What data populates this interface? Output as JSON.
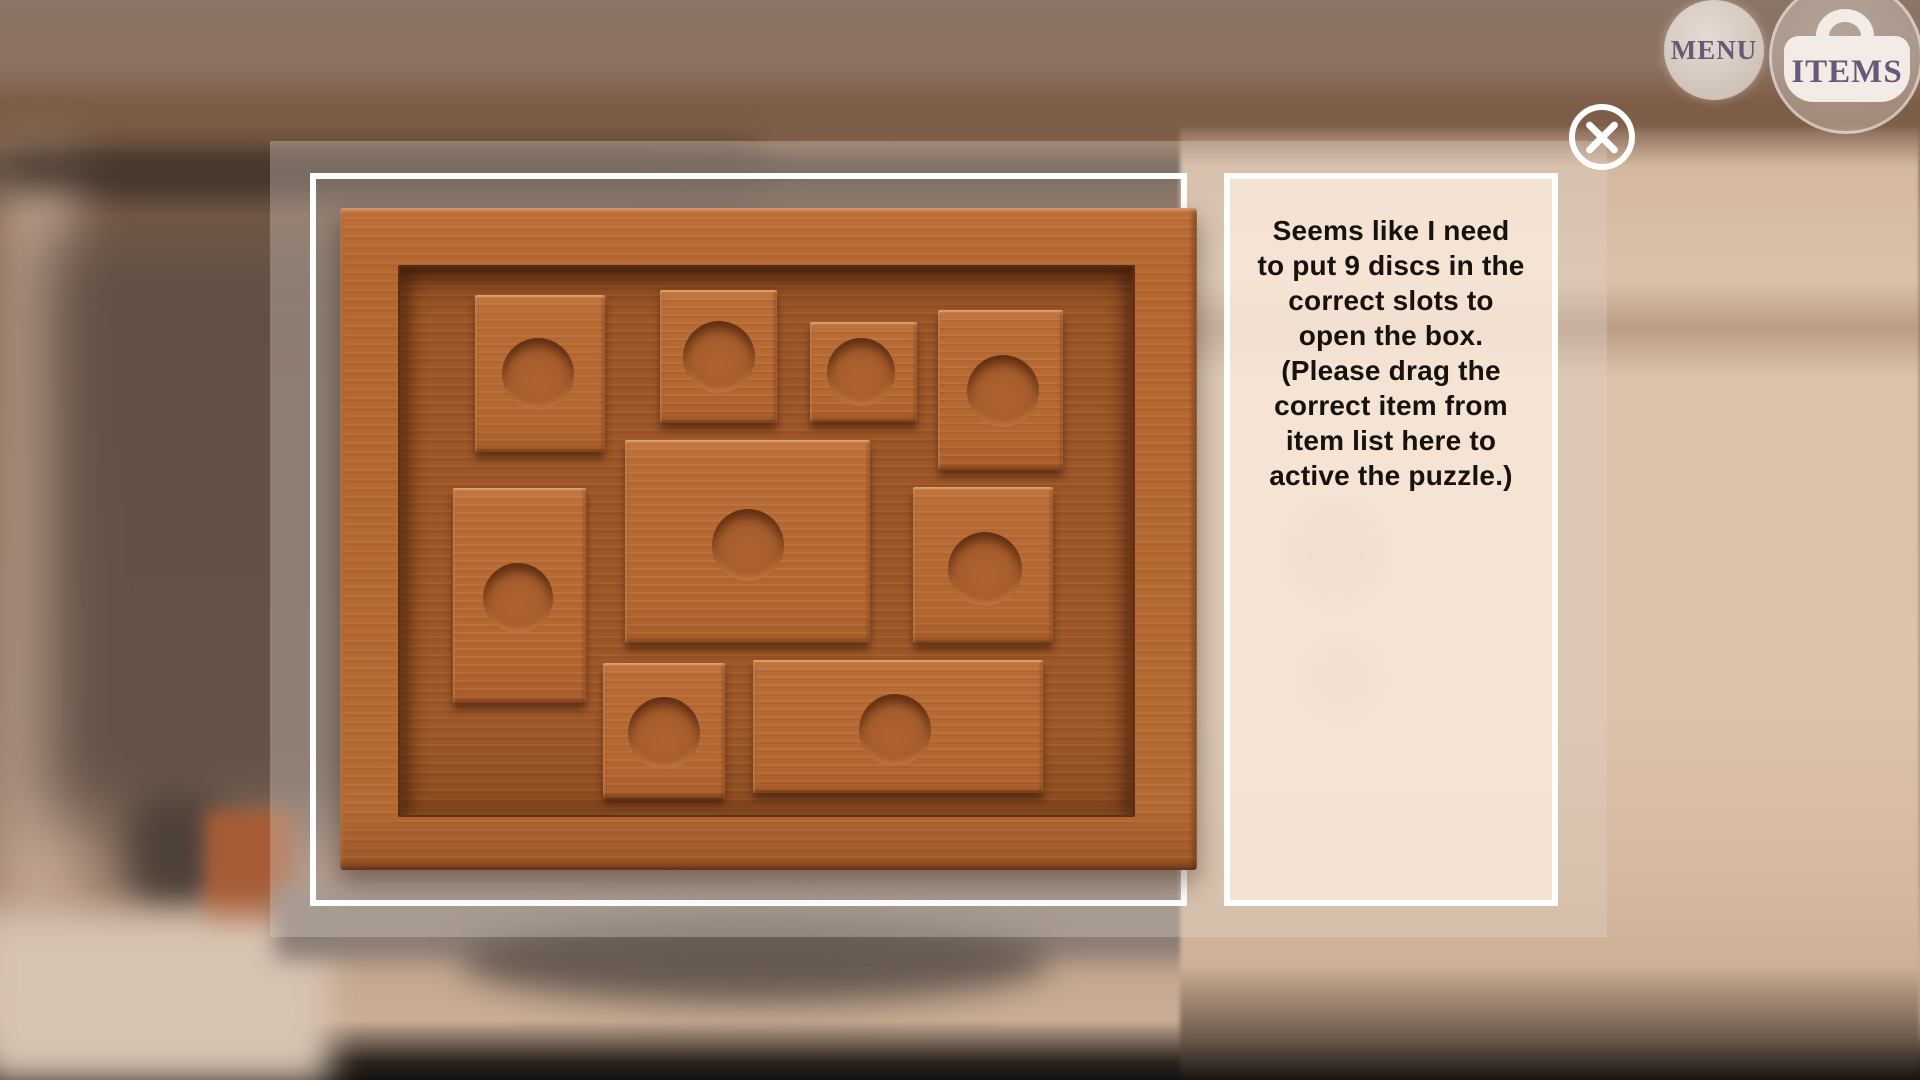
{
  "hud": {
    "menu_label": "MENU",
    "items_label": "ITEMS"
  },
  "dialog": {
    "instruction": "Seems like I need\nto put 9 discs in the\ncorrect slots to\nopen the box.\n(Please drag the\ncorrect item from\nitem list here to\nactive the puzzle.)"
  },
  "puzzle": {
    "name": "wooden disc puzzle box",
    "disc_slot_count": 9,
    "tiles": [
      {
        "id": "tile-1",
        "x": 135,
        "y": 87,
        "w": 130,
        "h": 157,
        "slot": {
          "cx": 63,
          "cy": 79,
          "r": 36
        }
      },
      {
        "id": "tile-2",
        "x": 320,
        "y": 82,
        "w": 117,
        "h": 133,
        "slot": {
          "cx": 59,
          "cy": 67,
          "r": 36
        }
      },
      {
        "id": "tile-3",
        "x": 470,
        "y": 114,
        "w": 107,
        "h": 100,
        "slot": {
          "cx": 51,
          "cy": 50,
          "r": 34
        }
      },
      {
        "id": "tile-4",
        "x": 598,
        "y": 102,
        "w": 125,
        "h": 160,
        "slot": {
          "cx": 65,
          "cy": 81,
          "r": 36
        }
      },
      {
        "id": "tile-5",
        "x": 113,
        "y": 280,
        "w": 133,
        "h": 215,
        "slot": {
          "cx": 65,
          "cy": 110,
          "r": 35
        }
      },
      {
        "id": "tile-6",
        "x": 285,
        "y": 232,
        "w": 245,
        "h": 203,
        "slot": {
          "cx": 123,
          "cy": 105,
          "r": 36
        }
      },
      {
        "id": "tile-7",
        "x": 573,
        "y": 279,
        "w": 140,
        "h": 156,
        "slot": {
          "cx": 72,
          "cy": 82,
          "r": 37
        }
      },
      {
        "id": "tile-8",
        "x": 263,
        "y": 455,
        "w": 122,
        "h": 135,
        "slot": {
          "cx": 61,
          "cy": 70,
          "r": 36
        }
      },
      {
        "id": "tile-9",
        "x": 413,
        "y": 452,
        "w": 290,
        "h": 133,
        "slot": {
          "cx": 142,
          "cy": 70,
          "r": 36
        }
      }
    ]
  },
  "colors": {
    "accent_purple": "#6b5875",
    "wood_frame": "#b4672f",
    "wood_recess": "#9a5426",
    "wood_tile": "#b96c38",
    "panel_border": "#ffffff",
    "text_panel_bg": "#f5e4d2",
    "instruction_text": "#17120e"
  }
}
